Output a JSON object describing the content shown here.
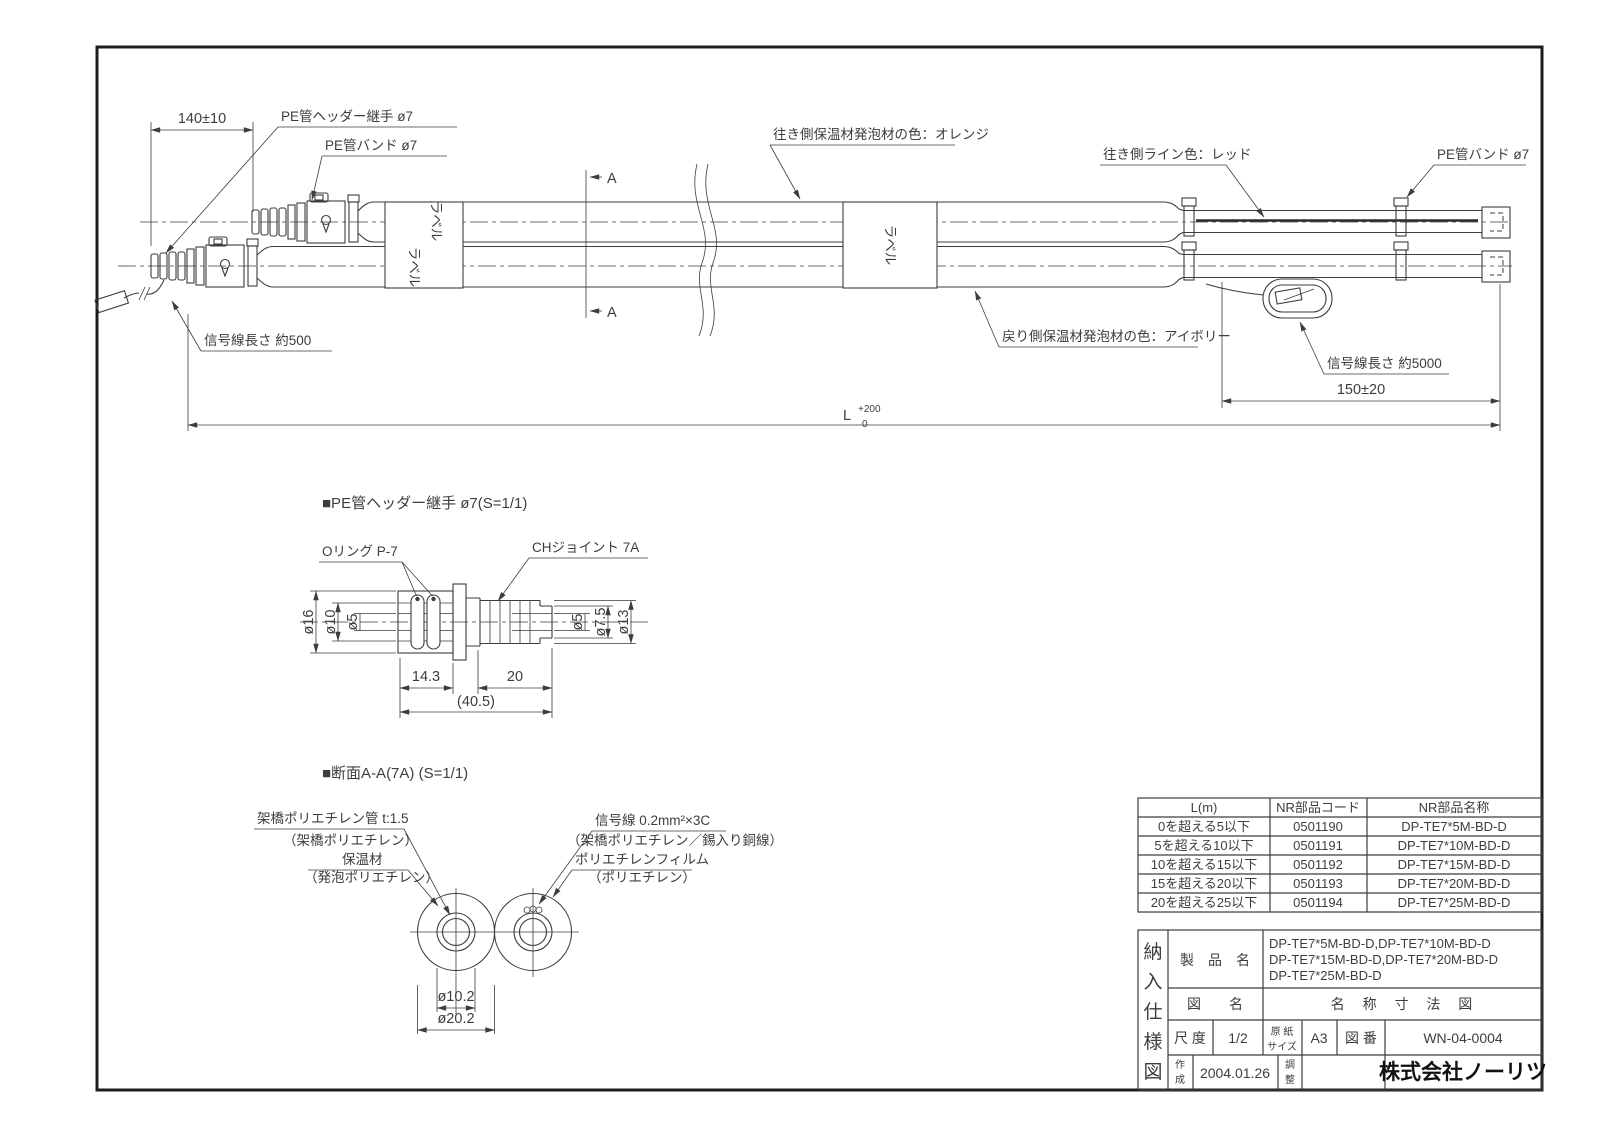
{
  "main_view": {
    "dim_140": "140±10",
    "dim_150": "150±20",
    "dim_L": "L",
    "dim_L_tol_upper": "+200",
    "dim_L_tol_lower": "0",
    "section_marker_top": "A",
    "section_marker_bottom": "A",
    "label_tag": "ラベル",
    "ann_pe_header_joint": "PE管ヘッダー継手 ø7",
    "ann_pe_band_left": "PE管バンド ø7",
    "ann_pe_band_right": "PE管バンド ø7",
    "ann_supply_insulation_color": "往き側保温材発泡材の色：オレンジ",
    "ann_supply_line_color": "往き側ライン色：レッド",
    "ann_return_insulation_color": "戻り側保温材発泡材の色：アイボリー",
    "ann_signal_length_left": "信号線長さ 約500",
    "ann_signal_length_right": "信号線長さ 約5000"
  },
  "joint_detail": {
    "title": "■PE管ヘッダー継手 ø7(S=1/1)",
    "ann_oring": "Oリング P-7",
    "ann_ch_joint": "CHジョイント 7A",
    "dia_16": "ø16",
    "dia_10": "ø10",
    "dia_5_left": "ø5",
    "dia_5_right": "ø5",
    "dia_7_5": "ø7.5",
    "dia_13": "ø13",
    "dim_14_3": "14.3",
    "dim_20": "20",
    "dim_40_5": "(40.5)"
  },
  "section_detail": {
    "title": "■断面A-A(7A) (S=1/1)",
    "xlpe_pipe": "架橋ポリエチレン管 t:1.5",
    "xlpe_pipe_sub": "（架橋ポリエチレン）",
    "insulation": "保温材",
    "insulation_sub": "（発泡ポリエチレン）",
    "signal_wire": "信号線 0.2mm²×3C",
    "signal_wire_sub": "（架橋ポリエチレン／錫入り銅線）",
    "pe_film": "ポリエチレンフィルム",
    "pe_film_sub": "（ポリエチレン）",
    "dia_10_2": "ø10.2",
    "dia_20_2": "ø20.2"
  },
  "parts_table": {
    "col_l": "L(m)",
    "col_code": "NR部品コード",
    "col_name": "NR部品名称",
    "rows": [
      {
        "l": "0を超える5以下",
        "code": "0501190",
        "name": "DP-TE7*5M-BD-D"
      },
      {
        "l": "5を超える10以下",
        "code": "0501191",
        "name": "DP-TE7*10M-BD-D"
      },
      {
        "l": "10を超える15以下",
        "code": "0501192",
        "name": "DP-TE7*15M-BD-D"
      },
      {
        "l": "15を超える20以下",
        "code": "0501193",
        "name": "DP-TE7*20M-BD-D"
      },
      {
        "l": "20を超える25以下",
        "code": "0501194",
        "name": "DP-TE7*25M-BD-D"
      }
    ]
  },
  "title_block": {
    "vertical": [
      "納",
      "入",
      "仕",
      "様",
      "図"
    ],
    "product_label": "製　品　名",
    "product_lines": [
      "DP-TE7*5M-BD-D,DP-TE7*10M-BD-D",
      "DP-TE7*15M-BD-D,DP-TE7*20M-BD-D",
      "DP-TE7*25M-BD-D"
    ],
    "fig_label": "図　　名",
    "fig_name": "名 称 寸 法 図",
    "scale_label": "尺 度",
    "scale_value": "1/2",
    "paper_label_1": "原 紙",
    "paper_label_2": "サイズ",
    "paper_value": "A3",
    "no_label": "図 番",
    "no_value": "WN-04-0004",
    "created_label_1": "作",
    "created_label_2": "成",
    "created_value": "2004.01.26",
    "adjust_label_1": "調",
    "adjust_label_2": "整",
    "company": "株式会社ノーリツ"
  }
}
